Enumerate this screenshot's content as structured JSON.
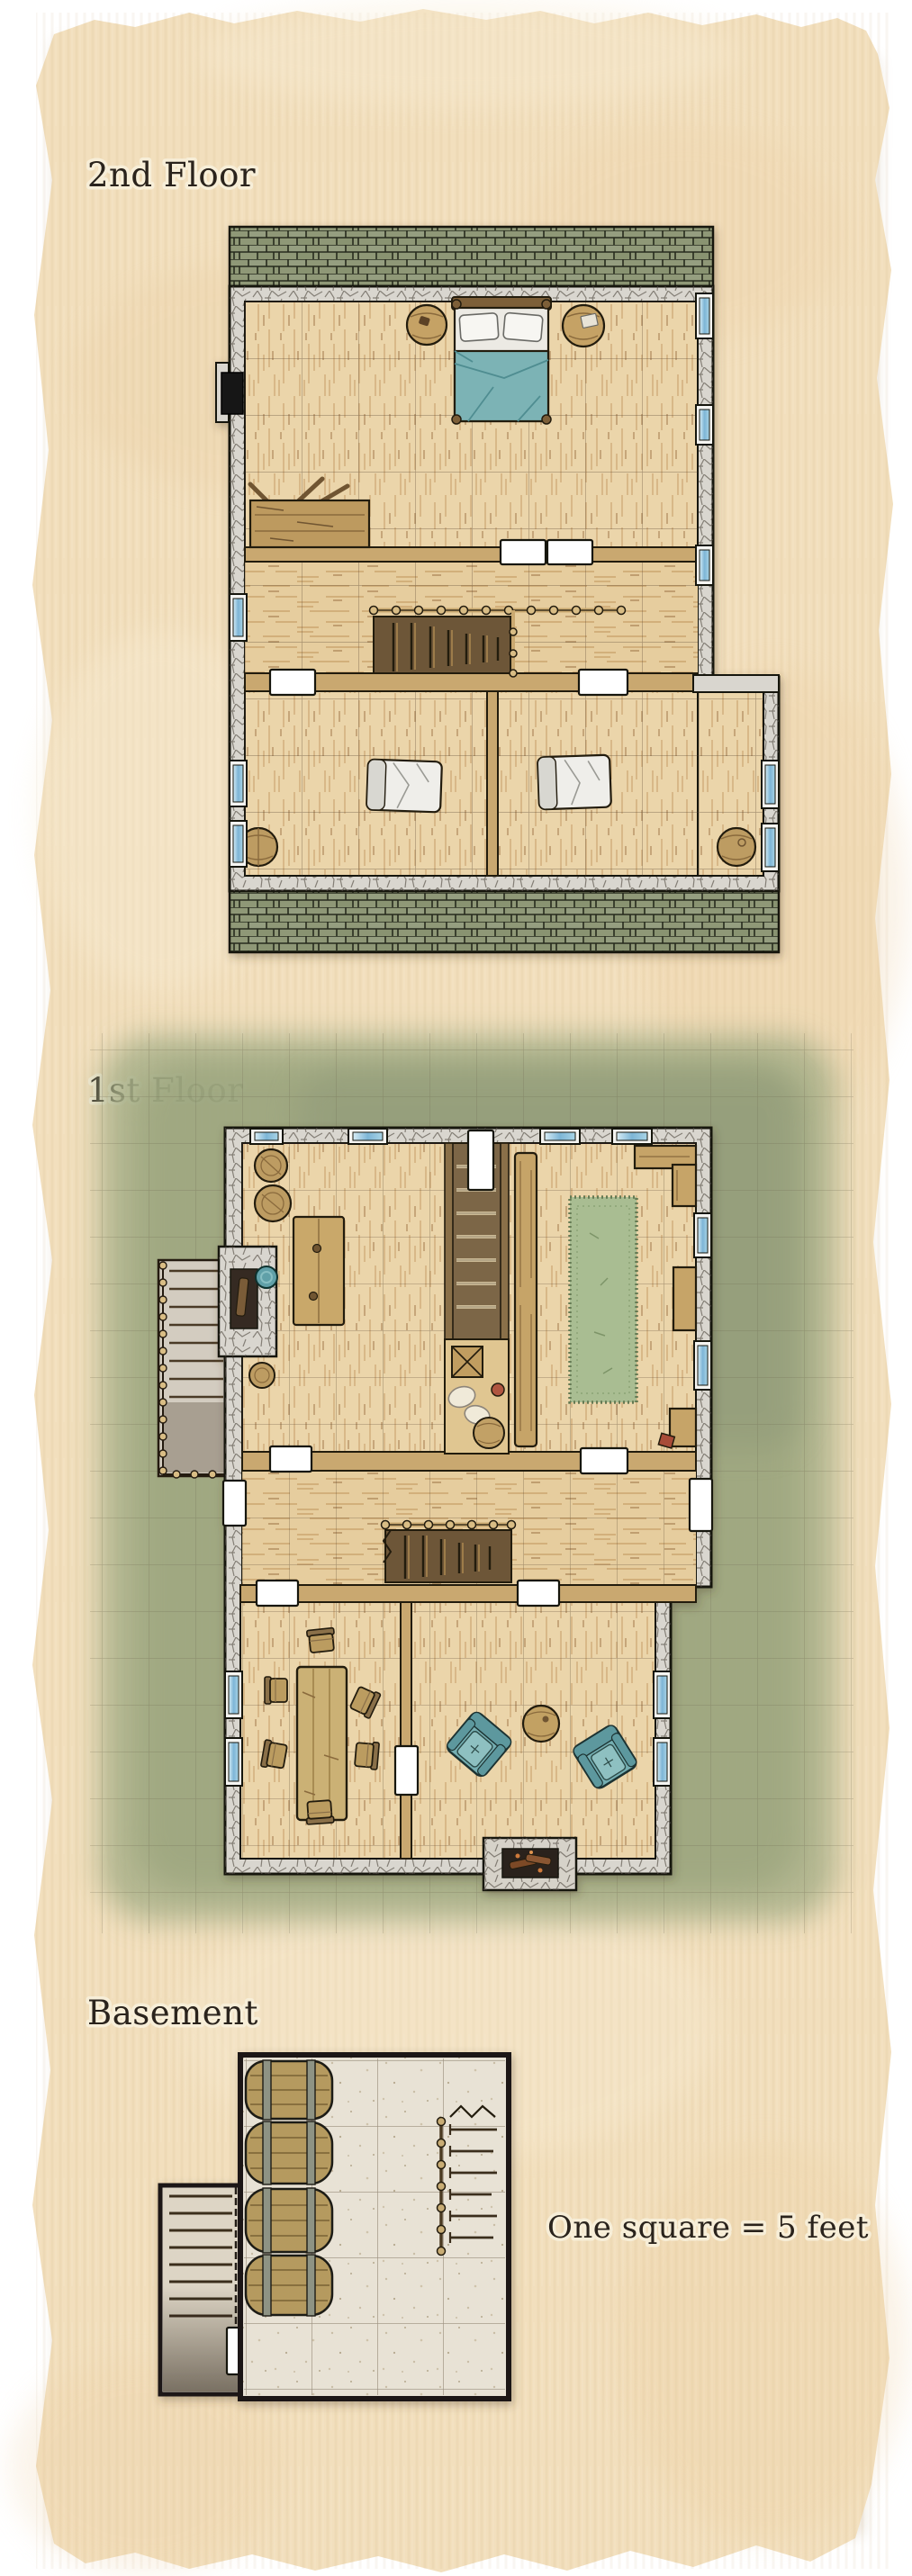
{
  "labels": {
    "second_floor": "2nd Floor",
    "first_floor": "1st Floor",
    "basement": "Basement",
    "scale_note": "One square = 5 feet"
  },
  "palette": {
    "page_background": "#ffffff",
    "parchment": "#f2dfbd",
    "ink_outline": "#171410",
    "label_ink": "#2a231c",
    "roof_green": "#8f9877",
    "stone_wall": "#d9d6cf",
    "wood_floor": "#ebd5aa",
    "wood_furniture": "#c2a164",
    "window_blue": "#7db5d6",
    "door_white": "#ffffff",
    "exterior_door_dark": "#181614",
    "textile_teal": "#77b0b4",
    "bedding_white": "#efeeea",
    "rug_green": "#a9bd92",
    "grass_green": "#a8b089",
    "basement_floor": "#e8e2d5"
  },
  "map_data": {
    "type": "rpg-battle-map-floorplan",
    "scale": "One square = 5 feet",
    "floors": [
      {
        "name": "2nd Floor",
        "features": [
          "green shingled roof strips along top and bottom edges",
          "stone outer walls with blue glazed windows",
          "wood plank flooring with 5-ft grid",
          "dark exterior door on west wall"
        ],
        "rooms": [
          {
            "name": "master bedroom",
            "furniture": [
              "double bed with teal blanket and two pillows",
              "round side table (left of bed)",
              "round side table (right of bed)",
              "storage crate with kindling sticks"
            ]
          },
          {
            "name": "stair landing",
            "furniture": [
              "staircase down with post-and-rail balustrade",
              "double white doors to master bedroom"
            ]
          },
          {
            "name": "west small bedroom",
            "furniture": [
              "white bedroll",
              "round barrel table in corner"
            ]
          },
          {
            "name": "east small bedroom",
            "furniture": [
              "white bedroll",
              "round barrel table in corner"
            ]
          }
        ]
      },
      {
        "name": "1st Floor",
        "features": [
          "grassy yard with 5-ft grid around the house",
          "stone outer walls",
          "exterior stone stair porch on the west side",
          "white interior doors"
        ],
        "rooms": [
          {
            "name": "kitchen / workroom",
            "furniture": [
              "two round barrels in north-west corner",
              "work table",
              "hearth with teal cauldron on west wall",
              "small barrel"
            ]
          },
          {
            "name": "stairwell",
            "furniture": [
              "staircase up",
              "front door on north wall",
              "pantry nook with crate, sacks, keg and red jug"
            ]
          },
          {
            "name": "common room",
            "furniture": [
              "long bar counter",
              "long green rug",
              "corner serving counter (north-east)",
              "two wall benches",
              "small red box"
            ]
          },
          {
            "name": "hallway",
            "furniture": [
              "staircase down",
              "west door to porch",
              "east door to yard"
            ]
          },
          {
            "name": "dining room",
            "furniture": [
              "long dining table",
              "six chairs"
            ]
          },
          {
            "name": "sitting room",
            "furniture": [
              "two teal armchairs",
              "round table",
              "stone fireplace on south wall"
            ]
          }
        ]
      },
      {
        "name": "Basement",
        "features": [
          "stone-flagged floor with 5-ft grid",
          "plain dark walls"
        ],
        "rooms": [
          {
            "name": "cellar",
            "furniture": [
              "four large barrels lying along the west wall",
              "railed staircase up on the east side",
              "exterior stair corridor on the west with white door"
            ]
          }
        ]
      }
    ]
  }
}
